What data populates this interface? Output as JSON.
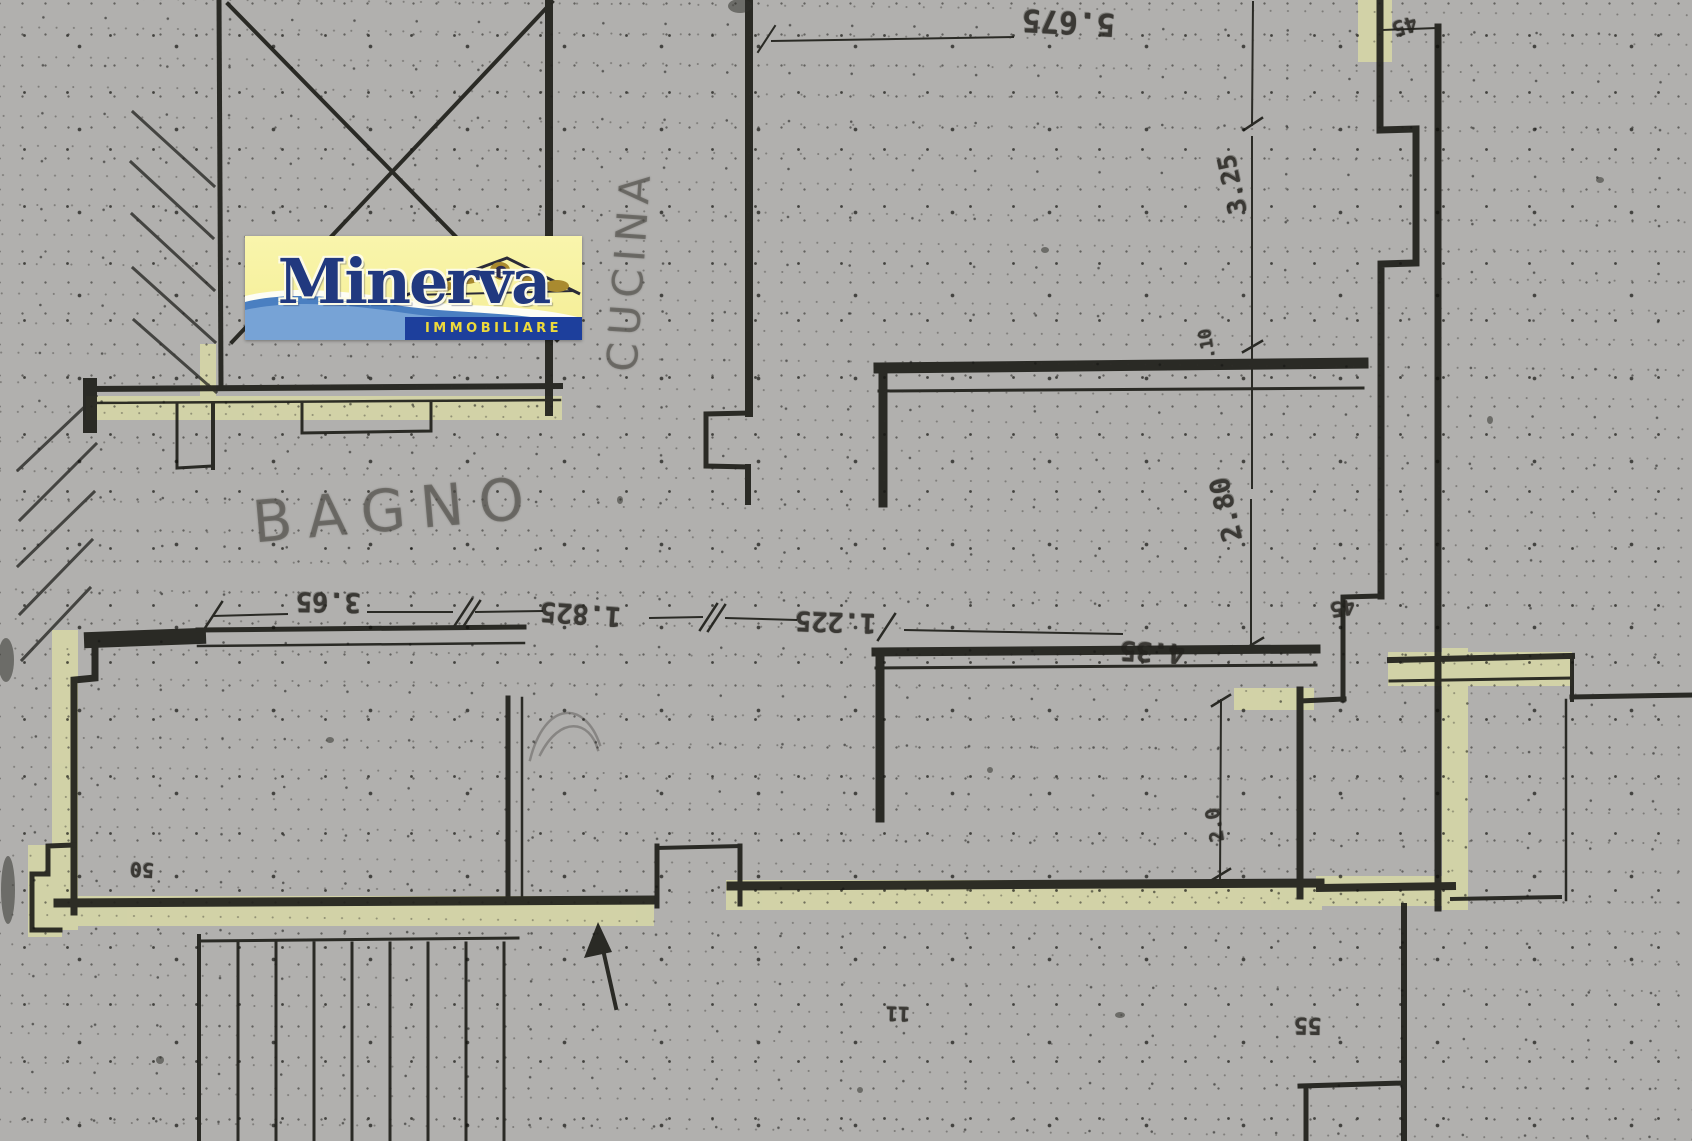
{
  "scan": {
    "paper_color": "#b1b0ae",
    "ink_color": "#21211d",
    "highlight_color": "#d8d9a4"
  },
  "logo": {
    "brand": "Minerva",
    "tagline": "IMMOBILIARE",
    "bg_color": "#f7f2a0",
    "band_color": "#1d3f9c",
    "brand_color": "#21397f",
    "tagline_color": "#eeda3b",
    "wave_color": "#5d90c9",
    "ornament_color": "#a98a2f"
  },
  "rooms": [
    {
      "label": "BAGNO"
    },
    {
      "label": "CUCINA"
    }
  ],
  "dimensions": {
    "top_width": "5.675",
    "bagno_width": "3.65",
    "hall_width": "1.825",
    "passage_width": "1.225",
    "camera_width": "4.35",
    "right_upper_height": "3.25",
    "wall_step": ".10",
    "right_lower_height": "2.80",
    "right_bottom_height": "2.0",
    "tick_top_right": "45",
    "tick_mid_right": "45",
    "tick_bottom_right": "55",
    "tick_bottom_center": "11",
    "tick_bottom_left": "50"
  }
}
